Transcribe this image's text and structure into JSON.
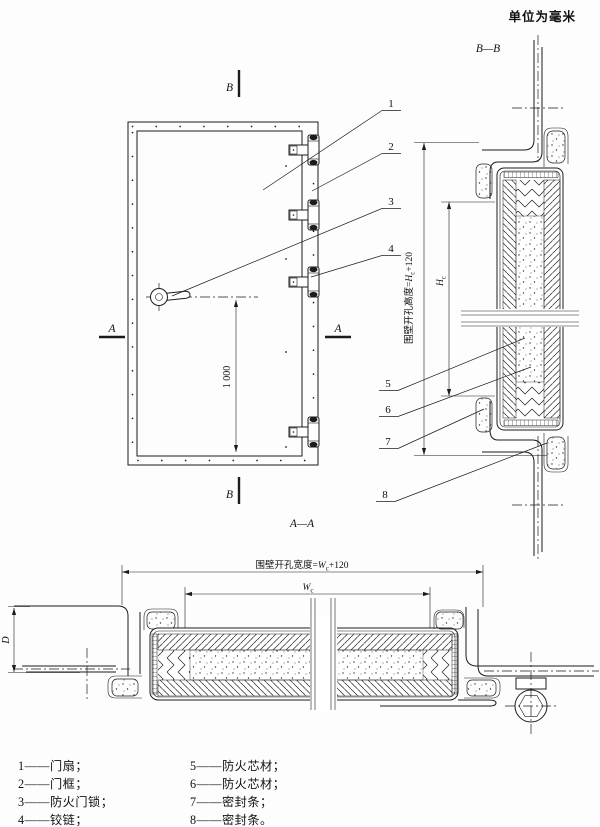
{
  "units_note": "单位为毫米",
  "colors": {
    "line": "#1c1c1c",
    "paper": "#fdfdfd"
  },
  "front": {
    "mark_top": "B",
    "mark_bottom": "B",
    "mark_left": "A",
    "mark_right": "A"
  },
  "titles": {
    "section_bb": "B—B",
    "section_aa": "A—A"
  },
  "dims": {
    "front_height": "1 000",
    "bb_outer_prefix": "围壁开孔高度=",
    "bb_sym": "H",
    "bb_sub": "c",
    "bb_suffix": "+120",
    "aa_outer_prefix": "围壁开孔宽度=",
    "aa_sym": "W",
    "aa_sub": "c",
    "aa_suffix": "+120",
    "depth": "D"
  },
  "callouts": [
    "1",
    "2",
    "3",
    "4",
    "5",
    "6",
    "7",
    "8"
  ],
  "legend": {
    "col1": [
      "1——门扇；",
      "2——门框；",
      "3——防火门锁；",
      "4——铰链；"
    ],
    "col2": [
      "5——防火芯材；",
      "6——防火芯材；",
      "7——密封条；",
      "8——密封条。"
    ]
  }
}
